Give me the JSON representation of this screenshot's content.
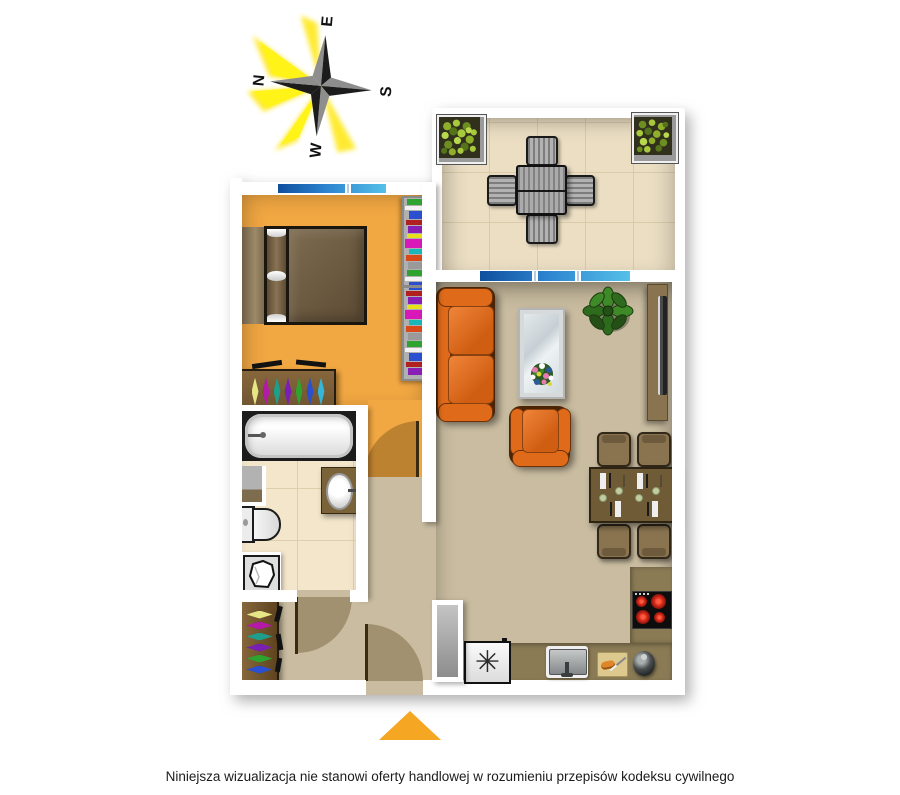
{
  "compass": {
    "labels": {
      "n": "N",
      "e": "E",
      "s": "S",
      "w": "W"
    },
    "rotation_deg": -85
  },
  "disclaimer": {
    "text": "Niniejsza wizualizacja nie stanowi oferty handlowej w rozumieniu przepisów kodeksu cywilnego"
  },
  "kitchen": {
    "freezer_symbol": "✳"
  },
  "palette": {
    "wall": "#FFFFFF",
    "bedroom-floor": "#F1A742",
    "living-floor": "#C9BCA0",
    "bathroom-floor": "#F3E6CB",
    "terrace-floor": "#EBDEC3",
    "kitchen-counter": "#8A7B55",
    "sofa-orange": "#DE6A1A",
    "furniture-brown": "#8A7450",
    "table-brown": "#6F5B36",
    "window-blue-dark": "#0F4F9E",
    "window-blue-light": "#55C0E8",
    "entrance-arrow": "#F5A623",
    "plant-green": "#2F6B1F",
    "burner-red": "#D42A1A"
  },
  "bookshelf": {
    "colors": [
      "#2fa32f",
      "#f2f2f2",
      "#2a4fd0",
      "#b02020",
      "#8a1fb5",
      "#e8e11a",
      "#d819b8",
      "#19b8b8",
      "#d84a1a",
      "#9a9a9a"
    ]
  },
  "bedroom_wardrobe": {
    "hanger_colors": [
      "#e6e687",
      "#b519a8",
      "#1f9e8c",
      "#7a1fb5",
      "#2fa32f",
      "#2a4fd0",
      "#35b5d8"
    ]
  },
  "hall_wardrobe": {
    "hanger_colors": [
      "#e6e687",
      "#b519a8",
      "#1f9e8c",
      "#7a1fb5",
      "#2fa32f",
      "#2a4fd0"
    ]
  }
}
